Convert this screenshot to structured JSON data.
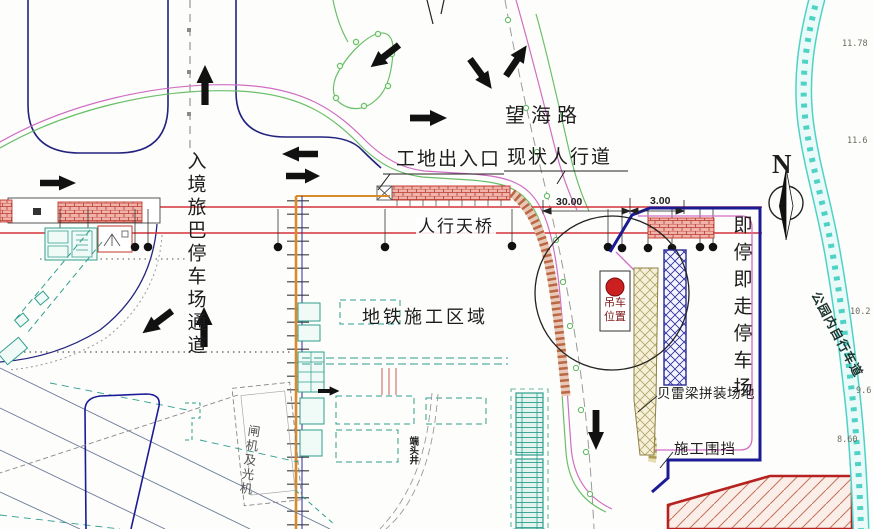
{
  "drawing": {
    "labels": {
      "wanghai_road": "望海路",
      "site_entrance": "工地出入口",
      "existing_sidewalk": "现状人行道",
      "pedestrian_bridge": "人行天桥",
      "metro_construction_area": "地铁施工区域",
      "inbound_bus_channel": "入境旅巴停车场通道",
      "stop_and_go_parking": "即停即走停车场",
      "bailey_beam_yard": "贝雷梁拼装场地",
      "construction_fence": "施工围挡",
      "park_bike_path": "公园内自行车道",
      "crane_position": "吊车位置",
      "gate_building": "闸机及光机",
      "shaft_label": "端头井"
    },
    "compass": {
      "north": "N"
    },
    "dimensions": {
      "d30": "30.00",
      "d3": "3.00"
    },
    "elevations": [
      "11.78",
      "11.6",
      "10.2",
      "9.6",
      "8.60"
    ],
    "colors": {
      "boundary_navy": "#1b1b96",
      "bridge_red": "#d4343a",
      "fence_orange": "#d98a2b",
      "sidewalk_green": "#6abf69",
      "sidewalk_magenta": "#cf6ec4",
      "bike_band_cyan": "#4fd2c6",
      "structure_teal": "#2f9e8e",
      "crane_dot_red": "#cc1f1f"
    }
  }
}
